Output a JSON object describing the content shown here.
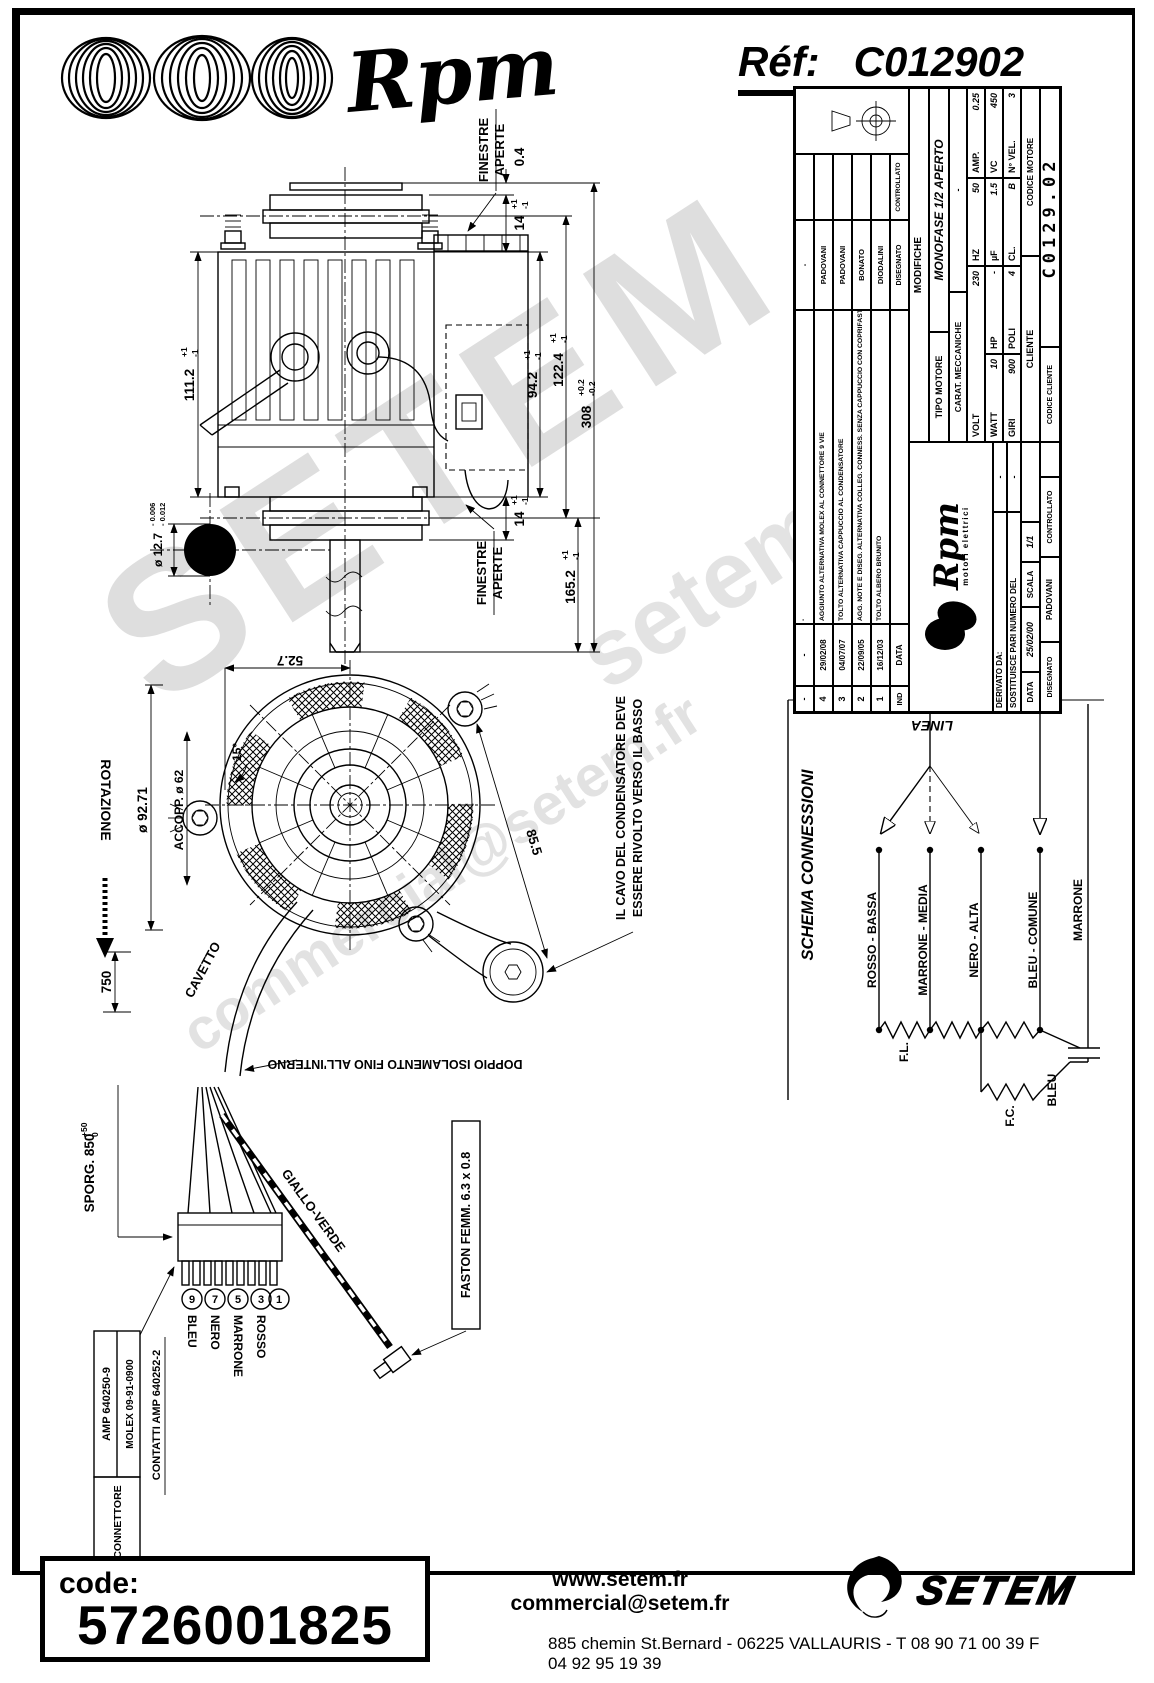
{
  "header": {
    "brand": "Rpm",
    "ref_label": "Réf:",
    "ref_value": "C012902"
  },
  "wm": {
    "big": "SETEM",
    "site": "setem.fr",
    "email": "commercial@setem.fr"
  },
  "tb": {
    "mods_rows": [
      {
        "ind": "-",
        "date": "-",
        "desc": "-",
        "name": "-"
      },
      {
        "ind": "4",
        "date": "29/02/08",
        "desc": "AGGIUNTO ALTERNATIVA MOLEX AL CONNETTORE 9 VIE",
        "name": "PADOVANI"
      },
      {
        "ind": "3",
        "date": "04/07/07",
        "desc": "TOLTO ALTERNATIVA CAPPUCCIO AL CONDENSATORE",
        "name": "PADOVANI"
      },
      {
        "ind": "2",
        "date": "22/09/05",
        "desc": "AGG. NOTE E DISEG. ALTERNATIVA COLLEG. CONNESS. SENZA CAPPUCCIO CON COPRIFASTON R.P.M.",
        "name": "BONATO"
      },
      {
        "ind": "1",
        "date": "16/12/03",
        "desc": "TOLTO ALBERO BRUNITO",
        "name": "DIODALINI"
      }
    ],
    "ind": "IND",
    "data": "DATA",
    "disegnato": "DISEGNATO",
    "controllato": "CONTROLLATO",
    "modifiche": "MODIFICHE",
    "tipo_l": "TIPO MOTORE",
    "tipo_v": "MONOFASE 1/2 APERTO",
    "carat_l": "CARAT. MECCANICHE",
    "carat_v": "-",
    "volt": "VOLT",
    "volt_v": "230",
    "hz": "HZ",
    "hz_v": "50",
    "amp": "AMP.",
    "amp_v": "0.25",
    "watt": "WATT",
    "watt_v": "10",
    "hp": "HP",
    "hp_v": "-",
    "uf": "µF",
    "uf_v": "1.5",
    "vc": "VC",
    "vc_v": "450",
    "giri": "GIRI",
    "giri_v": "900",
    "poli": "POLI",
    "poli_v": "4",
    "cl": "CL.",
    "cl_v": "B",
    "nvel": "N° VEL.",
    "nvel_v": "3",
    "cliente": "CLIENTE",
    "cod_mot": "CODICE MOTORE",
    "cod_cli": "CODICE CLIENTE",
    "cod_mot_v": "C0129.02",
    "derivato": "DERIVATO DA:",
    "derivato_v": "-",
    "sost": "SOSTITUISCE PARI NUMERO DEL",
    "sost_v": "-",
    "data_l": "DATA",
    "data_v": "25/02/00",
    "scala_l": "SCALA",
    "scala_v": "1/1",
    "diseg_v": "PADOVANI",
    "logo_brand": "Rpm",
    "logo_sub": "motori elettrici"
  },
  "schema": {
    "title": "SCHEMA CONNESSIONI",
    "linea": "LINEA",
    "wires": [
      "ROSSO - BASSA",
      "MARRONE - MEDIA",
      "NERO - ALTA",
      "BLEU - COMUNE",
      "BLEU",
      "MARRONE"
    ],
    "fl": "F.L.",
    "fc": "F.C."
  },
  "side": {
    "finestre": "FINESTRE",
    "aperte": "APERTE",
    "d04": "0.4",
    "d14a": {
      "v": "14",
      "tp": "+1",
      "tm": "-1"
    },
    "d14b": {
      "v": "14",
      "tp": "+1",
      "tm": "-1"
    },
    "d111": {
      "v": "111.2",
      "tp": "+1",
      "tm": "-1"
    },
    "d94": {
      "v": "94.2",
      "tp": "+1",
      "tm": "-1"
    },
    "d122": {
      "v": "122.4",
      "tp": "+1",
      "tm": "-1"
    },
    "d308": {
      "v": "308",
      "tp": "+0.2",
      "tm": "-0.2"
    },
    "d165": {
      "v": "165.2",
      "tp": "+1",
      "tm": "-1"
    },
    "d127": {
      "v": "ø 12.7",
      "tp": "- 0.006",
      "tm": "- 0.012"
    }
  },
  "front": {
    "d527": "52.7",
    "d9271": "ø 92.71",
    "d62": "ACCOPP. ø 62",
    "d15": "15°",
    "d855": "85.5",
    "rotazione": "ROTAZIONE",
    "cavetto": "CAVETTO",
    "note1a": "IL CAVO DEL CONDENSATORE DEVE",
    "note1b": "ESSERE RIVOLTO VERSO IL BASSO",
    "note2": "DOPPIO ISOLAMENTO FINO ALL'INTERNO",
    "d750": "750",
    "sporg": {
      "v": "SPORG. 850",
      "tp": "+50",
      "tm": "0"
    }
  },
  "conn": {
    "pins": [
      "9",
      "7",
      "5",
      "3",
      "1"
    ],
    "colors": [
      "BLEU",
      "NERO",
      "MARRONE",
      "ROSSO"
    ],
    "giallo": "GIALLO-VERDE",
    "faston": "FASTON FEMM. 6.3 x 0.8",
    "connettore_label": "CONNETTORE",
    "connettore_rows": [
      "AMP 640250-9",
      "MOLEX 09-91-0900"
    ],
    "contatti": "CONTATTI AMP 640252-2"
  },
  "footer": {
    "code_label": "code:",
    "code_value": "5726001825",
    "website": "www.setem.fr",
    "email": "commercial@setem.fr",
    "address": "885 chemin St.Bernard  -  06225 VALLAURIS  -  T 08 90 71 00 39   F 04 92 95 19 39",
    "brand": "SETEM"
  }
}
